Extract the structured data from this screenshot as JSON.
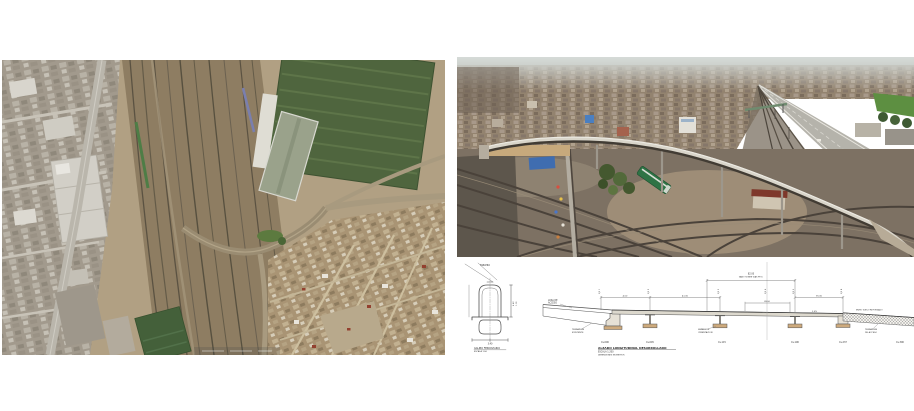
{
  "figure": {
    "description": "Viaduct project composite figure: satellite map of rail yard area, aerial photograph of curved viaduct over railway, and longitudinal elevation drawing",
    "background": "#ffffff"
  },
  "map_panel": {
    "type": "satellite-image",
    "palette": {
      "ground": "#b1a083",
      "rail_corridor": "#8e7d62",
      "track": "#5b5242",
      "road": "#bab6ac",
      "urban_blocks": "#a59d8f",
      "warehouse_roof": "#4f653e",
      "housing": "#a99474",
      "tree_green": "#5c7a3f"
    }
  },
  "photo_panel": {
    "type": "aerial-photograph",
    "palette": {
      "sky_haze": "#d6dbd8",
      "city": "#93836f",
      "highway": "#b5b3ab",
      "rail_yard": "#7d7163",
      "viaduct_deck": "#dcd8cd",
      "train_green": "#2e7345",
      "tarp_blue": "#3f6db0",
      "field_green": "#5d8f41",
      "roof_red": "#7e382b"
    }
  },
  "drawing_panel": {
    "title": "ALZADO LONGITUDINAL DESARROLLADO",
    "scale_note": "ESCALA 1:200",
    "units_note": "DIMENSIONES EN METROS",
    "gauge_detail": {
      "leader_label": "TABLERO",
      "caption": [
        "GALIBO FERROVIARIO",
        "ESCALA 1:50"
      ],
      "dim_bottom": "3.40",
      "dim_right": [
        "4.43",
        "1.10"
      ]
    },
    "elevation": {
      "leader_left": [
        "LOSA DE",
        "ACCESO"
      ],
      "label_approach": [
        "TERRAPLEN",
        "EXISTENTE"
      ],
      "label_footing": [
        "ZAPATA DE",
        "CIMENTACION"
      ],
      "label_ramp": [
        "TERRAPLEN",
        "DE ACCESO"
      ],
      "label_ramp_top": "MURO SUELO REFORZADO",
      "span_main": [
        "82.00",
        "VANO SOBRE VIAS FFCC"
      ],
      "spans": [
        "4.00",
        "41.00",
        "35.00",
        "28.00"
      ],
      "slope": "2.0%",
      "axis_labels": [
        "EJE 1",
        "EJE 2",
        "EJE 3",
        "EJE 4",
        "EJE 5",
        "EJE 6"
      ],
      "chainage": [
        "0+000",
        "0+045",
        "0+115",
        "0+190",
        "0+237",
        "0+300"
      ]
    }
  }
}
